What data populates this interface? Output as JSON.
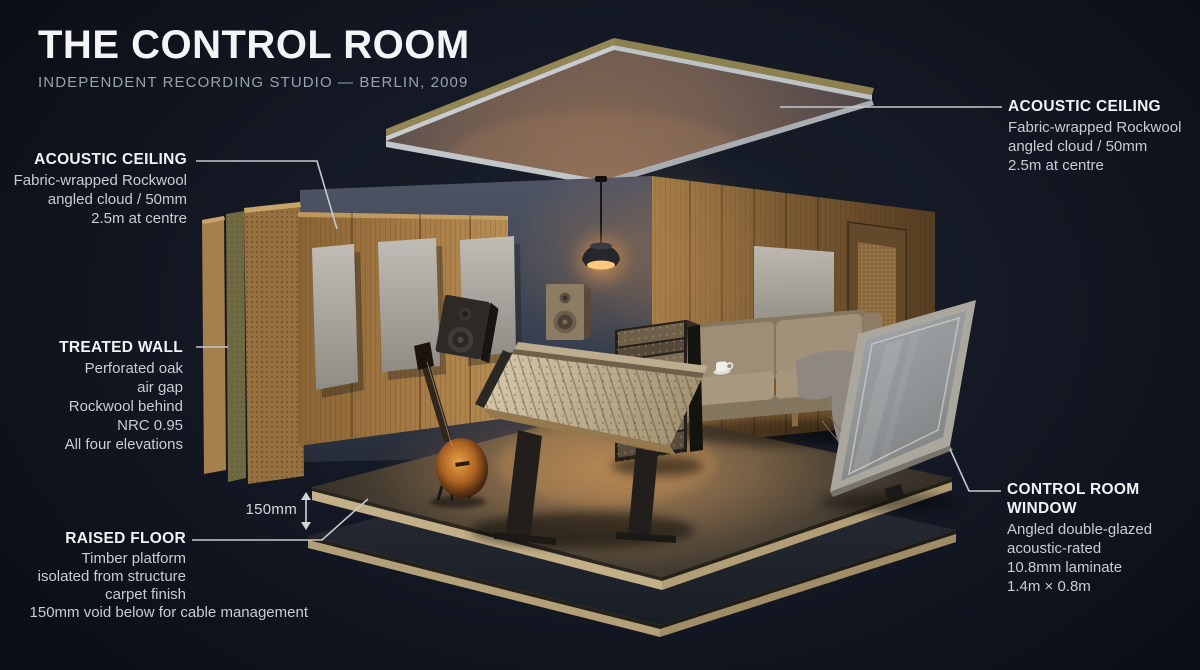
{
  "title": {
    "heading": "THE CONTROL ROOM",
    "subheading": "INDEPENDENT RECORDING STUDIO — BERLIN, 2009"
  },
  "labels": {
    "acoustic_ceiling_right": {
      "heading": "ACOUSTIC CEILING",
      "lines": [
        "Fabric-wrapped Rockwool",
        "angled cloud / 50mm",
        "2.5m at centre"
      ]
    },
    "acoustic_ceiling_left": {
      "heading": "ACOUSTIC CEILING",
      "lines": [
        "Fabric-wrapped Rockwool",
        "angled cloud / 50mm",
        "2.5m at centre"
      ]
    },
    "treated_wall": {
      "heading": "TREATED WALL",
      "lines": [
        "Perforated oak",
        "air gap",
        "Rockwool behind",
        "NRC 0.95",
        "All four elevations"
      ]
    },
    "raised_floor": {
      "heading": "RAISED FLOOR",
      "lines": [
        "Timber platform",
        "isolated from structure",
        "carpet finish",
        "150mm void below for cable management"
      ]
    },
    "control_room_window": {
      "heading": "CONTROL ROOM WINDOW",
      "lines": [
        "Angled double-glazed",
        "acoustic-rated",
        "10.8mm laminate",
        "1.4m × 0.8m"
      ]
    },
    "dimension_150mm": "150mm"
  },
  "scene_objects": [
    "acoustic ceiling panel",
    "pendant lamp",
    "painted back wall",
    "treated wall layers",
    "perforated oak panel",
    "rockwool layer",
    "oak finish panel",
    "fabric absorber panels",
    "wood panelled side wall",
    "door",
    "studio monitor (tilted)",
    "studio monitor (wall)",
    "mixing console",
    "outboard gear rack",
    "sofa",
    "coffee cup",
    "throw blanket",
    "electric guitar on stand",
    "raised floor platform",
    "structural slab",
    "control room window"
  ],
  "colors": {
    "background": "#10141c",
    "leader_line": "#c6c9cc",
    "heading_text": "#f1f2f4",
    "body_text": "#c9ccd2",
    "subtitle_text": "#99a1ac",
    "warm_light": "#ffc87a",
    "oak_wood": "#a87c46",
    "fabric_panel": "#b5b2ac",
    "rockwool": "#6f6a41",
    "wall_paint": "#3c4454",
    "carpet": "#6b5a44",
    "window_frame": "#aaa79f"
  }
}
